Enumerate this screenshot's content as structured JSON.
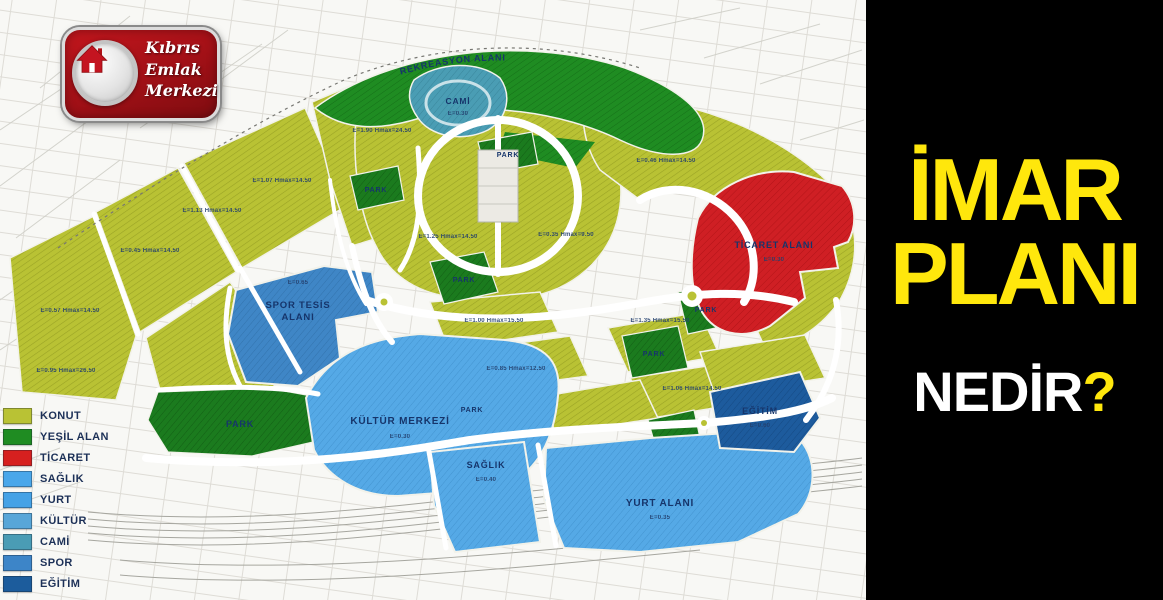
{
  "logo": {
    "line1": "Kıbrıs",
    "line2": "Emlak",
    "line3": "Merkezi"
  },
  "right_panel": {
    "title_line1": "İMAR",
    "title_line2": "PLANI",
    "subtitle": "NEDİR",
    "question_mark": "?",
    "background": "#000000",
    "title_color": "#ffe70c",
    "subtitle_color": "#ffffff"
  },
  "legend": {
    "items": [
      {
        "label": "KONUT",
        "color": "#b9c234"
      },
      {
        "label": "YEŞİL ALAN",
        "color": "#1f8c22"
      },
      {
        "label": "TİCARET",
        "color": "#d6201f"
      },
      {
        "label": "SAĞLIK",
        "color": "#4aa7ea"
      },
      {
        "label": "YURT",
        "color": "#45a2e6"
      },
      {
        "label": "KÜLTÜR",
        "color": "#58a6d8"
      },
      {
        "label": "CAMİ",
        "color": "#4a9cb5"
      },
      {
        "label": "SPOR",
        "color": "#3d85c8"
      },
      {
        "label": "EĞİTİM",
        "color": "#1c5c9c"
      }
    ]
  },
  "map": {
    "labels": {
      "rekreasyon": "REKREASYON ALANI",
      "cami": "CAMİ",
      "spor_line1": "SPOR TESİS",
      "spor_line2": "ALANI",
      "kultur": "KÜLTÜR MERKEZİ",
      "saglik": "SAĞLIK",
      "yurt": "YURT ALANI",
      "ticaret": "TİCARET ALANI",
      "egitim": "EĞİTİM",
      "park": "PARK"
    },
    "codes": [
      "E=0.57 Hmax=14.50",
      "E=0.45 Hmax=14.50",
      "E=1.13 Hmax=14.50",
      "E=1.07 Hmax=14.50",
      "E=0.95 Hmax=26.50",
      "E=1.90 Hmax=24.50",
      "E=1.25 Hmax=14.50",
      "E=0.35 Hmax=9.50",
      "E=0.46 Hmax=14.50",
      "E=1.35 Hmax=15.50",
      "E=1.00 Hmax=15.50",
      "E=0.85 Hmax=12.50",
      "E=1.06 Hmax=14.50",
      "E=0.30",
      "E=0.30",
      "E=0.40",
      "E=0.35",
      "E=0.60",
      "E=0.65",
      "E=0.30"
    ]
  }
}
